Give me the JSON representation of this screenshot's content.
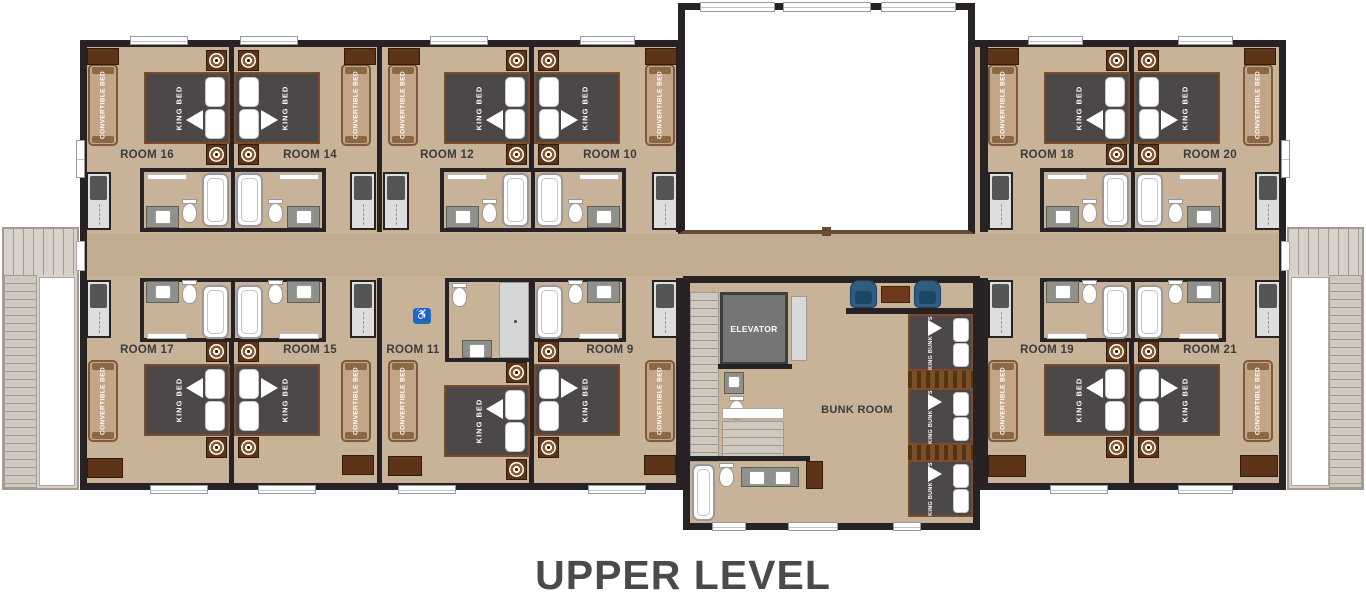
{
  "title": "UPPER LEVEL",
  "labels": {
    "king_bed": "KING BED",
    "convertible_bed": "CONVERTIBLE BED",
    "elevator": "ELEVATOR",
    "bunk_room": "BUNK ROOM",
    "king_bunk_beds": "KING BUNK BED'S",
    "accessible_symbol": "♿"
  },
  "rooms": {
    "r16": "ROOM 16",
    "r14": "ROOM 14",
    "r12": "ROOM 12",
    "r10": "ROOM 10",
    "r18": "ROOM 18",
    "r20": "ROOM 20",
    "r17": "ROOM 17",
    "r15": "ROOM 15",
    "r11": "ROOM 11",
    "r9": "ROOM 9",
    "r19": "ROOM 19",
    "r21": "ROOM 21"
  },
  "colors": {
    "floor": "#c8b298",
    "corridor": "#c1ab91",
    "wall": "#272324",
    "bed": "#4b4847",
    "bed_frame": "#7d4b2a",
    "convertible": "#c3a687",
    "wood": "#5e3418",
    "deck": "#d8d1c9",
    "deck_line": "#a39b91",
    "chair": "#2e5d80",
    "table": "#6e3a1b",
    "elevator": "#757575",
    "accessible": "#1f6eb5",
    "railing": "#6a4a33",
    "ladder": "#7d4e2b",
    "title": "#4a4a4c"
  }
}
